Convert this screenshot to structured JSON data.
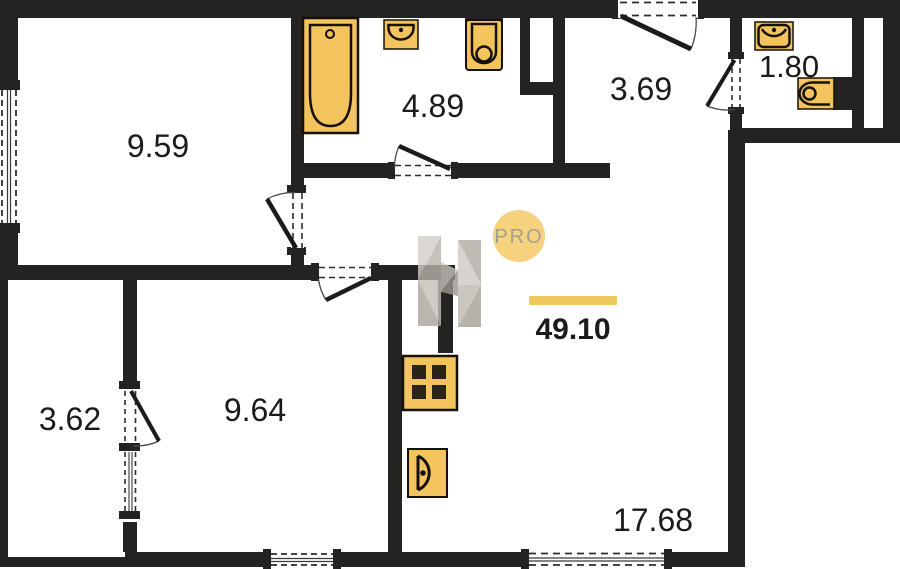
{
  "plan": {
    "title": "apartment-floor-plan",
    "total_area": "49.10",
    "watermark": {
      "badge": "PRO"
    },
    "rooms": [
      {
        "id": "bedroom",
        "area": "9.59"
      },
      {
        "id": "bathroom",
        "area": "4.89"
      },
      {
        "id": "hallway",
        "area": "3.69"
      },
      {
        "id": "wc",
        "area": "1.80"
      },
      {
        "id": "loggia",
        "area": "3.62"
      },
      {
        "id": "room",
        "area": "9.64"
      },
      {
        "id": "living-kitchen",
        "area": "17.68"
      }
    ],
    "fixtures": [
      "bathtub",
      "washbasin",
      "toilet",
      "washbasin",
      "toilet",
      "stove",
      "kitchen-sink"
    ],
    "colors": {
      "wall": "#242321",
      "fixture_fill": "#f3c45e",
      "fixture_stroke": "#151009",
      "accent_bar": "#efc85e",
      "badge_fill": "#f6d17e",
      "badge_text": "#a49e90"
    }
  }
}
